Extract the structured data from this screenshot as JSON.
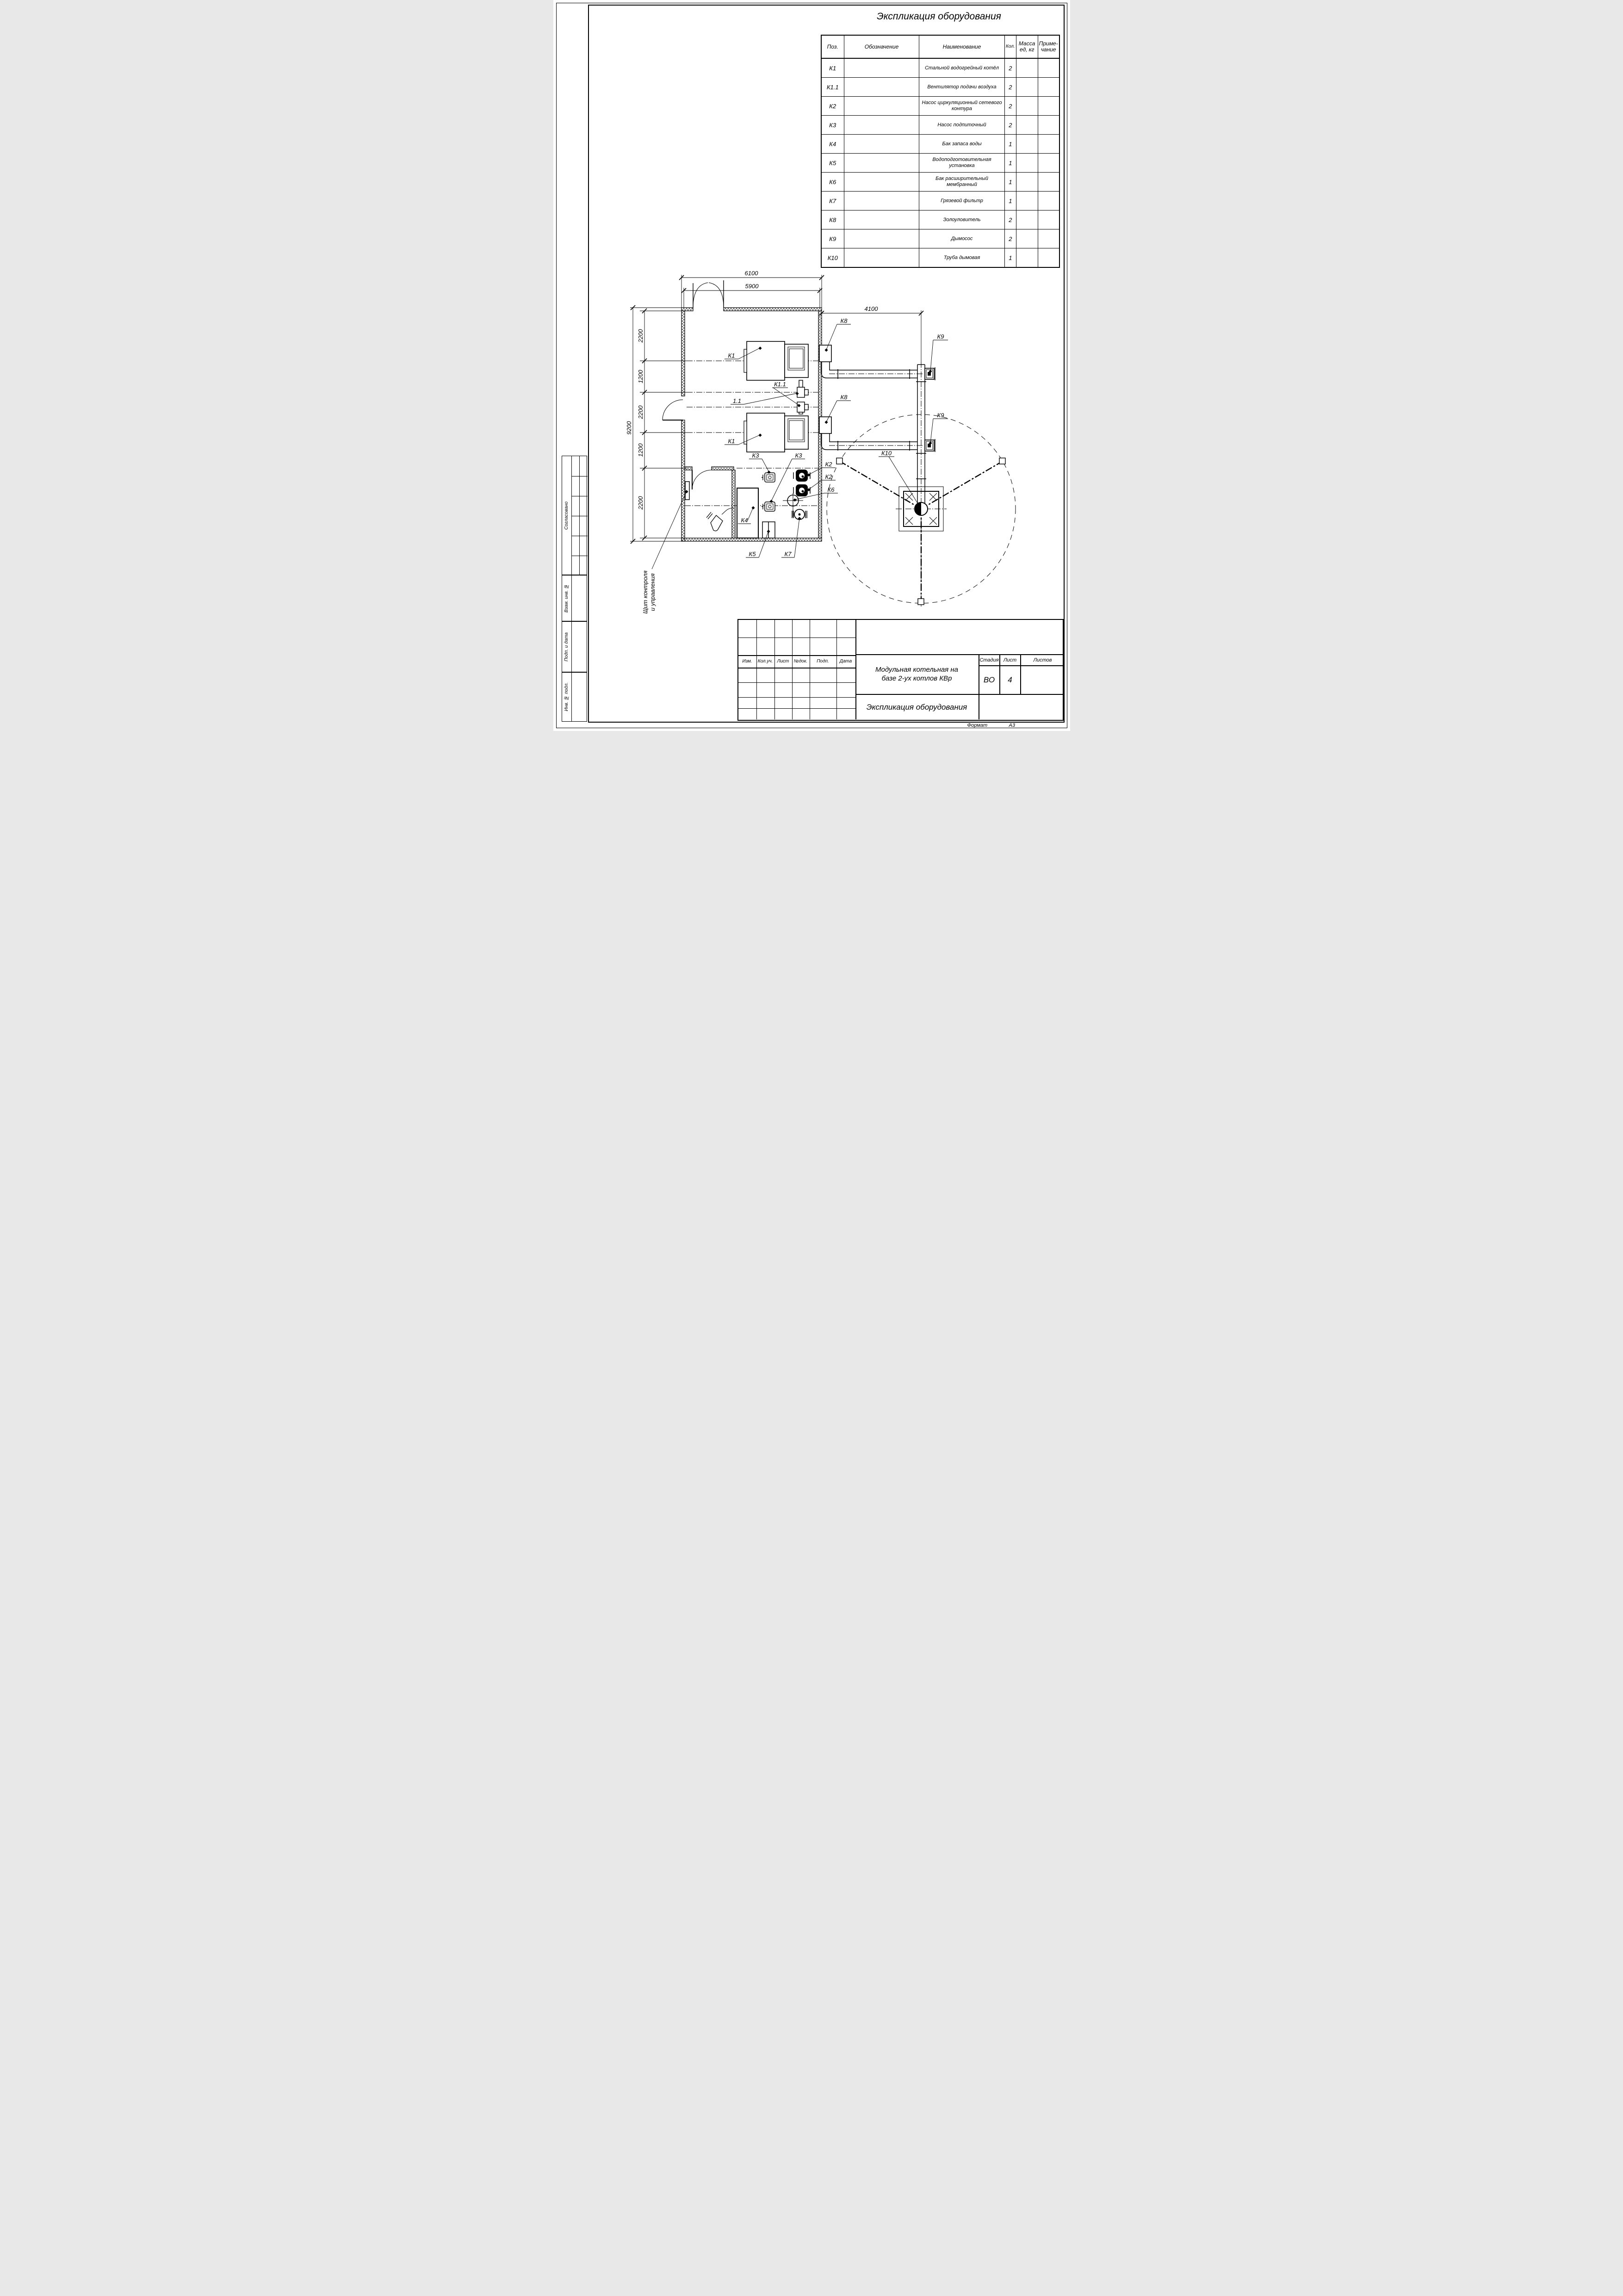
{
  "equipment_table": {
    "title": "Экспликация оборудования",
    "columns": {
      "pos": "Поз.",
      "designation": "Обозначение",
      "name": "Наименование",
      "qty": "Кол.",
      "mass_l1": "Масса",
      "mass_l2": "ед, кг",
      "note_l1": "Приме-",
      "note_l2": "чание"
    },
    "rows": [
      {
        "pos": "К1",
        "designation": "",
        "name": "Стальной водогрейный котёл",
        "qty": "2",
        "mass": "",
        "note": ""
      },
      {
        "pos": "К1.1",
        "designation": "",
        "name": "Вентилятор подачи воздуха",
        "qty": "2",
        "mass": "",
        "note": ""
      },
      {
        "pos": "К2",
        "designation": "",
        "name": "Насос циркуляционный сетевого контура",
        "qty": "2",
        "mass": "",
        "note": ""
      },
      {
        "pos": "К3",
        "designation": "",
        "name": "Насос подпиточный",
        "qty": "2",
        "mass": "",
        "note": ""
      },
      {
        "pos": "К4",
        "designation": "",
        "name": "Бак запаса воды",
        "qty": "1",
        "mass": "",
        "note": ""
      },
      {
        "pos": "К5",
        "designation": "",
        "name": "Водоподготовительная установка",
        "qty": "1",
        "mass": "",
        "note": ""
      },
      {
        "pos": "К6",
        "designation": "",
        "name": "Бак расширительный мембранный",
        "qty": "1",
        "mass": "",
        "note": ""
      },
      {
        "pos": "К7",
        "designation": "",
        "name": "Грязевой фильтр",
        "qty": "1",
        "mass": "",
        "note": ""
      },
      {
        "pos": "К8",
        "designation": "",
        "name": "Золоуловитель",
        "qty": "2",
        "mass": "",
        "note": ""
      },
      {
        "pos": "К9",
        "designation": "",
        "name": "Дымосос",
        "qty": "2",
        "mass": "",
        "note": ""
      },
      {
        "pos": "К10",
        "designation": "",
        "name": "Труба дымовая",
        "qty": "1",
        "mass": "",
        "note": ""
      }
    ]
  },
  "drawing": {
    "dimensions": {
      "top_outer": "6100",
      "top_inner": "5900",
      "chimney_offset": "4100",
      "left_overall": "9200",
      "chain": [
        "2200",
        "1200",
        "2200",
        "1200",
        "2200"
      ]
    },
    "labels": {
      "boiler1": "К1",
      "boiler2": "К1",
      "fan1": "1.1",
      "fan2": "К1.1",
      "ash1": "К8",
      "ash2": "К8",
      "exhauster1": "К9",
      "exhauster2": "К9",
      "chimney": "К10",
      "pump_feed1": "К3",
      "pump_feed2": "К3",
      "pump_net1": "К2",
      "pump_net2": "К2",
      "exp_tank": "К6",
      "water_tank": "К4",
      "water_treatment": "К5",
      "filter": "К7"
    },
    "annotation": {
      "line1": "Щит контроля",
      "line2": "и управления"
    }
  },
  "title_block": {
    "revision_columns": [
      "Изм.",
      "Кол.уч.",
      "Лист",
      "№док.",
      "Подп.",
      "Дата"
    ],
    "project_title_l1": "Модульная котельная на",
    "project_title_l2": "базе 2-ух котлов КВр",
    "sheet_title": "Экспликация оборудования",
    "stage_label": "Стадия",
    "sheet_label": "Лист",
    "sheets_label": "Листов",
    "stage_value": "ВО",
    "sheet_value": "4",
    "sheets_value": ""
  },
  "sidebar": {
    "labels": [
      "Согласовано",
      "Взам. инв. №",
      "Подп. и дата",
      "Инв. № подл."
    ]
  },
  "footer": {
    "format_label": "Формат",
    "format_value": "А3"
  }
}
